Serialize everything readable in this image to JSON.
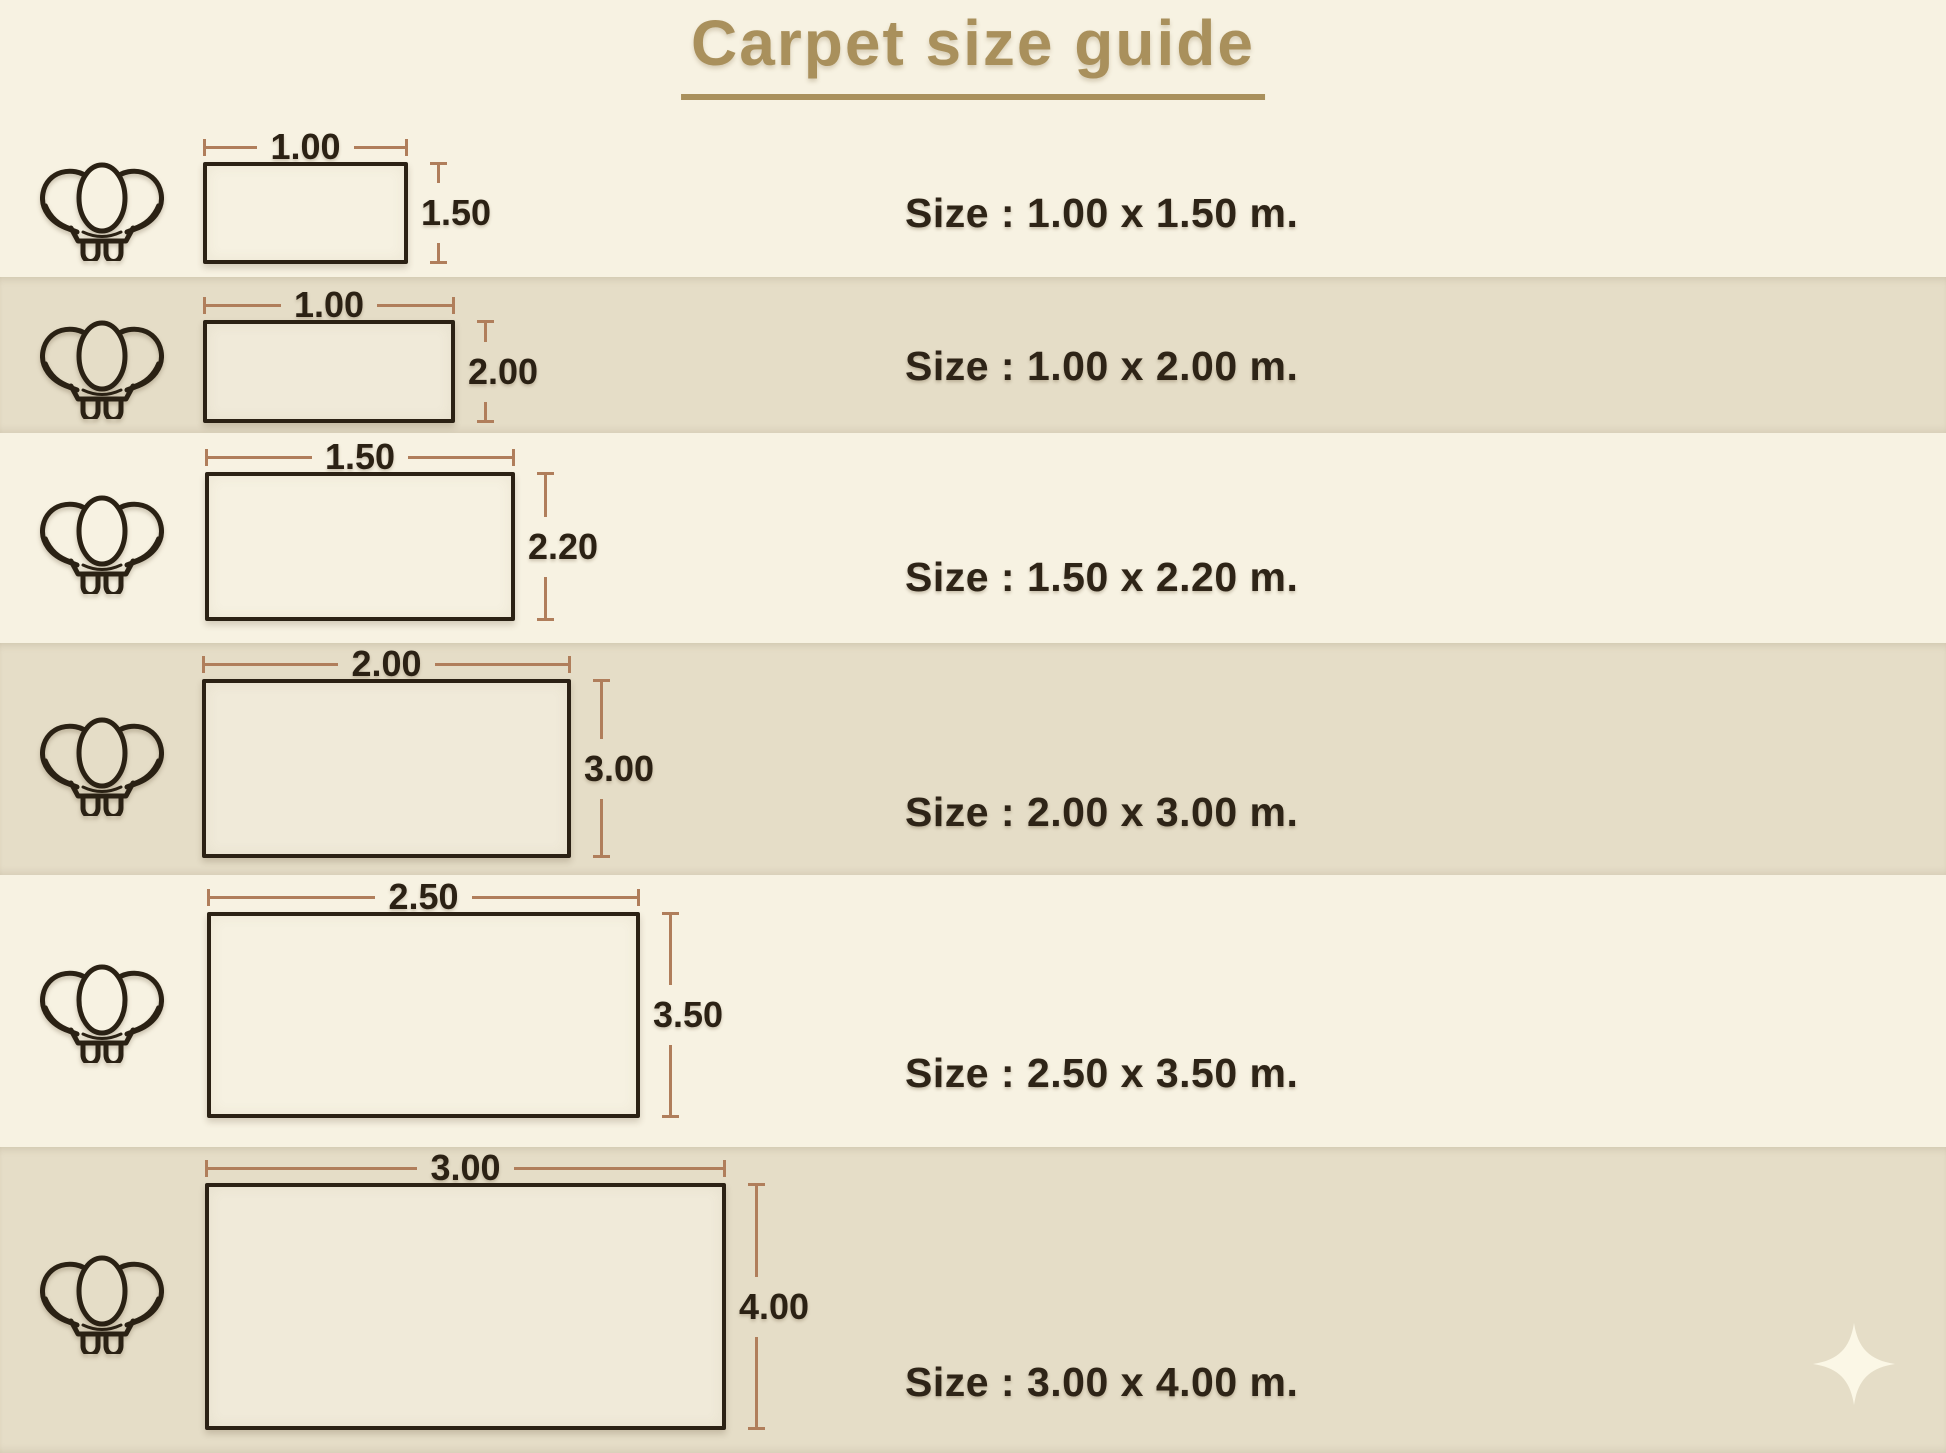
{
  "title": "Carpet size guide",
  "unit": "m.",
  "rows": [
    {
      "width_m": 1.0,
      "height_m": 1.5,
      "width_label": "1.00",
      "height_label": "1.50",
      "size_text": "Size : 1.00 x 1.50 m."
    },
    {
      "width_m": 1.0,
      "height_m": 2.0,
      "width_label": "1.00",
      "height_label": "2.00",
      "size_text": "Size : 1.00 x 2.00 m."
    },
    {
      "width_m": 1.5,
      "height_m": 2.2,
      "width_label": "1.50",
      "height_label": "2.20",
      "size_text": "Size : 1.50 x 2.20 m."
    },
    {
      "width_m": 2.0,
      "height_m": 3.0,
      "width_label": "2.00",
      "height_label": "3.00",
      "size_text": "Size : 2.00 x 3.00 m."
    },
    {
      "width_m": 2.5,
      "height_m": 3.5,
      "width_label": "2.50",
      "height_label": "3.50",
      "size_text": "Size : 2.50 x 3.50 m."
    },
    {
      "width_m": 3.0,
      "height_m": 4.0,
      "width_label": "3.00",
      "height_label": "4.00",
      "size_text": "Size : 3.00 x 4.00 m."
    }
  ],
  "icons": {
    "row_icon": "armchair-top-view-icon",
    "decor_icon": "four-point-sparkle-icon"
  },
  "colors": {
    "background_cream": "#f7f2e2",
    "band_beige": "#e5ddc7",
    "ink": "#2b2114",
    "accent_gold": "#a9905c",
    "dimension_line": "#b07e5b",
    "sparkle": "#fbf7e6"
  }
}
